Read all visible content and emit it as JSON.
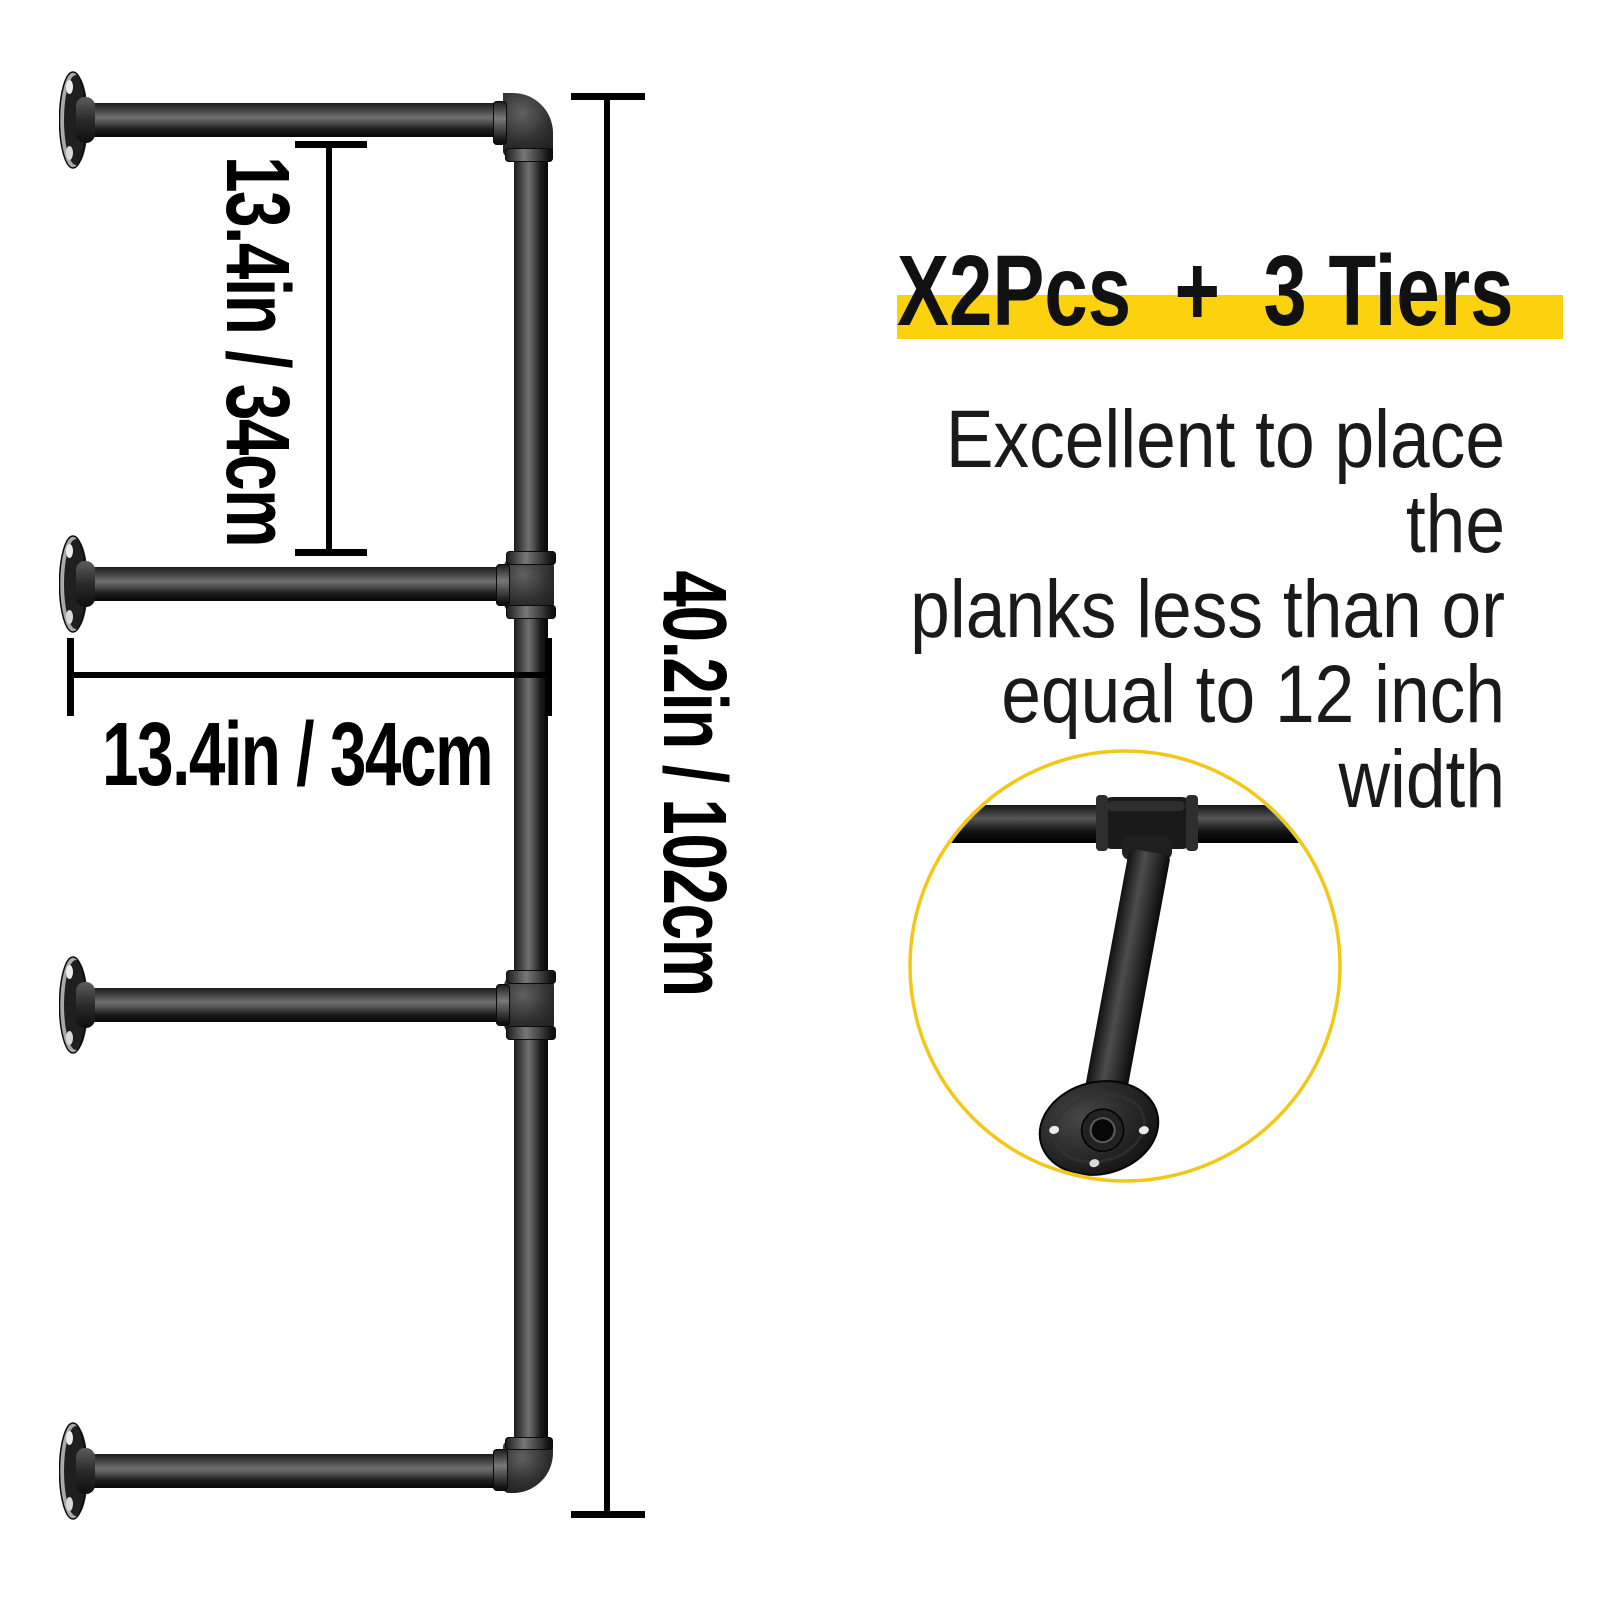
{
  "diagram": {
    "tier_gap_label": "13.4in / 34cm",
    "depth_label": "13.4in / 34cm",
    "height_label": "40.2in / 102cm"
  },
  "promo": {
    "headline": "X2Pcs  +  3 Tiers",
    "highlight_color": "#FCD20E",
    "description_lines": {
      "0": "Excellent to place the",
      "1": "planks less than or",
      "2": "equal to 12 inch width"
    }
  },
  "detail": {
    "circle_accent_color": "#F3C716",
    "shows": "pipe-tee-joint-with-wall-flange-closeup"
  },
  "colors": {
    "pipe": "#1b1b1b",
    "dimension_lines": "#000000",
    "body_text": "#1a1a1a",
    "background": "#ffffff"
  }
}
